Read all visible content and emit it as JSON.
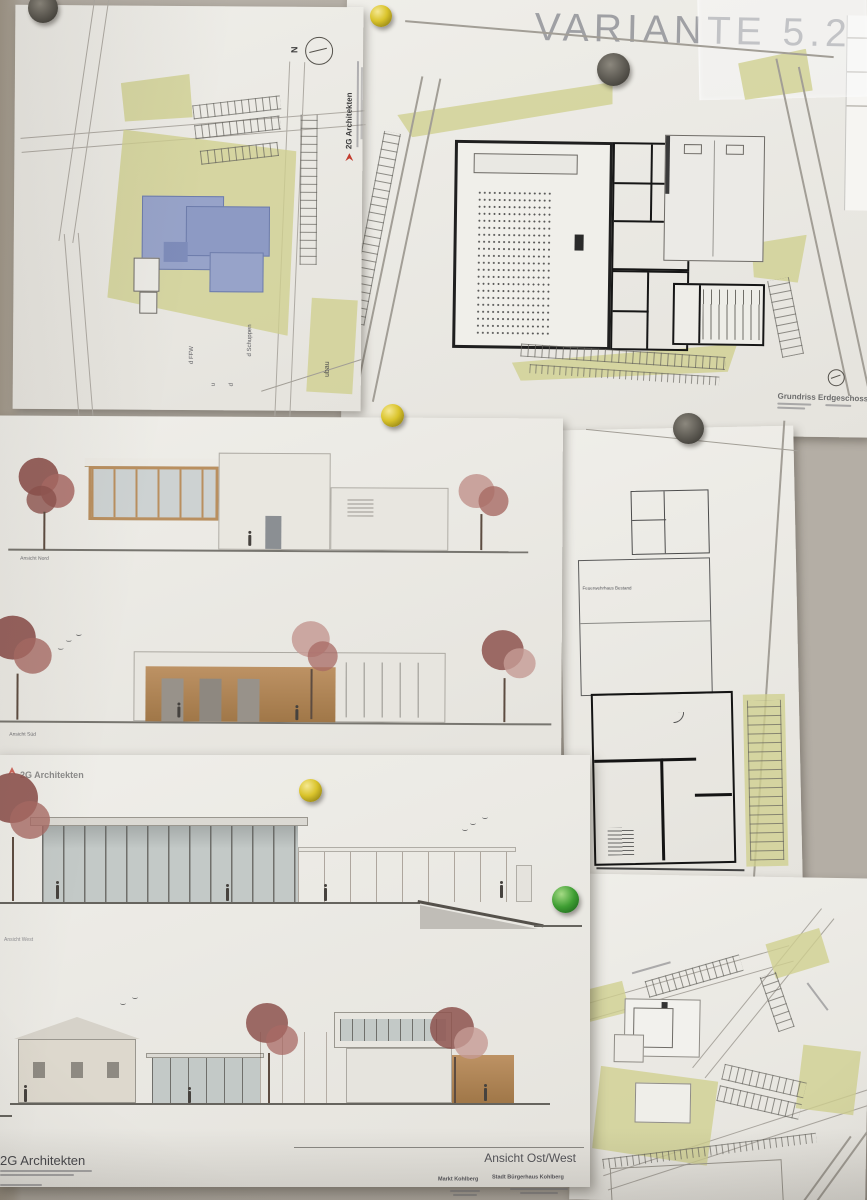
{
  "colors": {
    "brand_red": "#c23b2e",
    "landscape_olive": "#d0cf8e",
    "highlight_blue": "#95a2c8",
    "pin_yellow": "#dac42c",
    "pin_green": "#3f9e33",
    "pin_dark": "#57544d"
  },
  "site_plan": {
    "firm": "2G Architekten",
    "north": "N",
    "note_ffw": "d FFW",
    "note_u": "u",
    "note_d": "d",
    "note_schuppen": "d Schuppen",
    "edge_note": "ubau"
  },
  "floor_plan": {
    "variant": "VARIANTE 5.2",
    "caption": "Grundriss Erdgeschoss"
  },
  "elevations_ns": {
    "nord": "Ansicht Nord",
    "sued": "Ansicht Süd",
    "title": "Ansicht Nord/Süd"
  },
  "plan_right": {
    "label": "Feuerwehrhaus Bestand"
  },
  "elevations_ow": {
    "firm": "2G Architekten",
    "west": "Ansicht West",
    "title": "Ansicht Ost/West",
    "firm_footer": "2G Architekten",
    "client": "Markt Kohlberg",
    "project": "Stadt Bürgerhaus Kohlberg"
  }
}
